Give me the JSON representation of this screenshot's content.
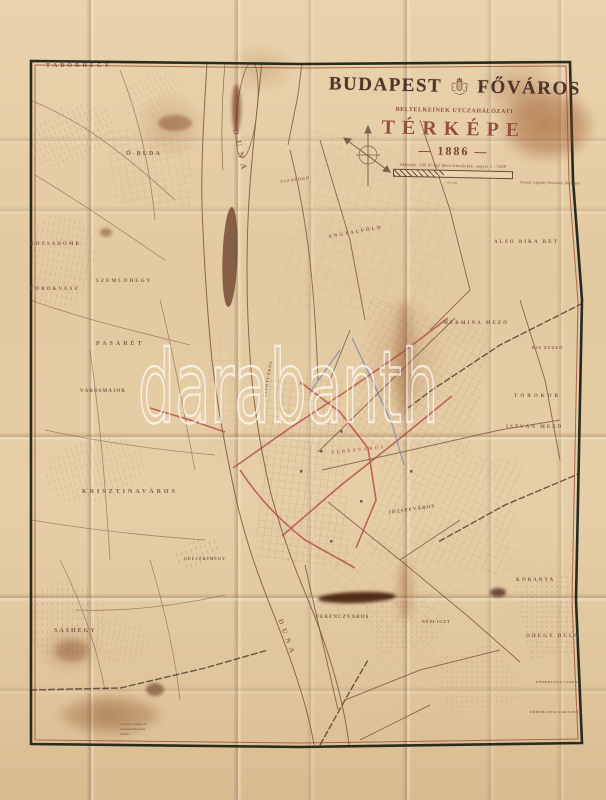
{
  "watermark": "darabanth",
  "cartouche": {
    "city": "BUDAPEST",
    "city2": "FŐVÁROS",
    "subtitle": "BELTELKEINEK UTCZAHÁLÓZATI",
    "map_word": "TÉRKÉPE",
    "year": "— 1886 —",
    "scale_note": "Mértéke: 100 öl egy bécsi hüvelykre, vagyis 1 : 7200",
    "scale_unit_label": "ölek",
    "imprint": "Nyomt. Légrády Testvérek, Budapest"
  },
  "colors": {
    "paper": "#e4cda8",
    "wood": "#b46a2c",
    "ink": "#5d4434",
    "red_line": "#b0504a",
    "blue_line": "#7585b5",
    "border": "#272b20"
  },
  "legend_lines": [
    "A veres vonalak az",
    "utczaszabályozást",
    "jelölik."
  ],
  "map_labels": [
    {
      "text": "TÁBORHEGY",
      "x": 46,
      "y": 63,
      "fs": 6,
      "ls": 3
    },
    {
      "text": "Ó-BUDA",
      "x": 126,
      "y": 151,
      "fs": 6,
      "ls": 2
    },
    {
      "text": "RÓZSADOMB",
      "x": 30,
      "y": 242,
      "fs": 5,
      "ls": 2
    },
    {
      "text": "SZEMLŐHEGY",
      "x": 96,
      "y": 279,
      "fs": 5,
      "ls": 2
    },
    {
      "text": "TÖRÖKVÉSZ",
      "x": 30,
      "y": 287,
      "fs": 5,
      "ls": 2
    },
    {
      "text": "PASARÉT",
      "x": 96,
      "y": 341,
      "fs": 6,
      "ls": 3
    },
    {
      "text": "VÁROSMAJOR",
      "x": 80,
      "y": 389,
      "fs": 5,
      "ls": 1
    },
    {
      "text": "KRISZTINAVÁROS",
      "x": 82,
      "y": 489,
      "fs": 6,
      "ls": 3
    },
    {
      "text": "SASHEGY",
      "x": 54,
      "y": 628,
      "fs": 6,
      "ls": 2
    },
    {
      "text": "GELLÉRTHEGY",
      "x": 184,
      "y": 556,
      "fs": 4,
      "ls": 1
    },
    {
      "text": "VIZAFOGÓ",
      "x": 280,
      "y": 179,
      "fs": 4,
      "ls": 1,
      "rot": -8
    },
    {
      "text": "ANGYALFÖLD",
      "x": 328,
      "y": 235,
      "fs": 5,
      "ls": 2,
      "rot": -10
    },
    {
      "text": "ALSÓ BIKA RÉT",
      "x": 494,
      "y": 240,
      "fs": 5,
      "ls": 2
    },
    {
      "text": "HERMINA MEZŐ",
      "x": 444,
      "y": 321,
      "fs": 5,
      "ls": 2
    },
    {
      "text": "KIS ZUGLÓ",
      "x": 532,
      "y": 345,
      "fs": 4,
      "ls": 1
    },
    {
      "text": "TÖRÖKŐR",
      "x": 514,
      "y": 394,
      "fs": 5,
      "ls": 3
    },
    {
      "text": "ISTVÁN MEZŐ",
      "x": 506,
      "y": 425,
      "fs": 5,
      "ls": 2
    },
    {
      "text": "TERÉZVÁROS",
      "x": 331,
      "y": 451,
      "fs": 5,
      "ls": 2,
      "rot": -6,
      "color": "#a8625a"
    },
    {
      "text": "LIPÓTVÁROS",
      "x": 262,
      "y": 396,
      "fs": 4,
      "ls": 1,
      "rot": -80
    },
    {
      "text": "JÓZSEFVÁROS",
      "x": 388,
      "y": 511,
      "fs": 5,
      "ls": 1,
      "rot": -8
    },
    {
      "text": "FERENCZVÁROS",
      "x": 316,
      "y": 615,
      "fs": 5,
      "ls": 1
    },
    {
      "text": "NÉPLIGET",
      "x": 422,
      "y": 619,
      "fs": 4,
      "ls": 1
    },
    {
      "text": "KŐBÁNYA",
      "x": 516,
      "y": 578,
      "fs": 5,
      "ls": 2
    },
    {
      "text": "ÓHEGY DŰLŐ",
      "x": 526,
      "y": 634,
      "fs": 5,
      "ls": 2
    },
    {
      "text": "FŐHERCZEG LIGET",
      "x": 536,
      "y": 680,
      "fs": 3.5,
      "ls": 0.5
    },
    {
      "text": "FŐHERCZEG LAKTANYA",
      "x": 530,
      "y": 710,
      "fs": 3.5,
      "ls": 0.5
    },
    {
      "text": "DUNA",
      "x": 240,
      "y": 128,
      "fs": 8,
      "ls": 6,
      "rot": 78,
      "color": "#7a5a42"
    },
    {
      "text": "DUNA",
      "x": 284,
      "y": 618,
      "fs": 7,
      "ls": 5,
      "rot": 70,
      "color": "#7a5a42"
    }
  ]
}
